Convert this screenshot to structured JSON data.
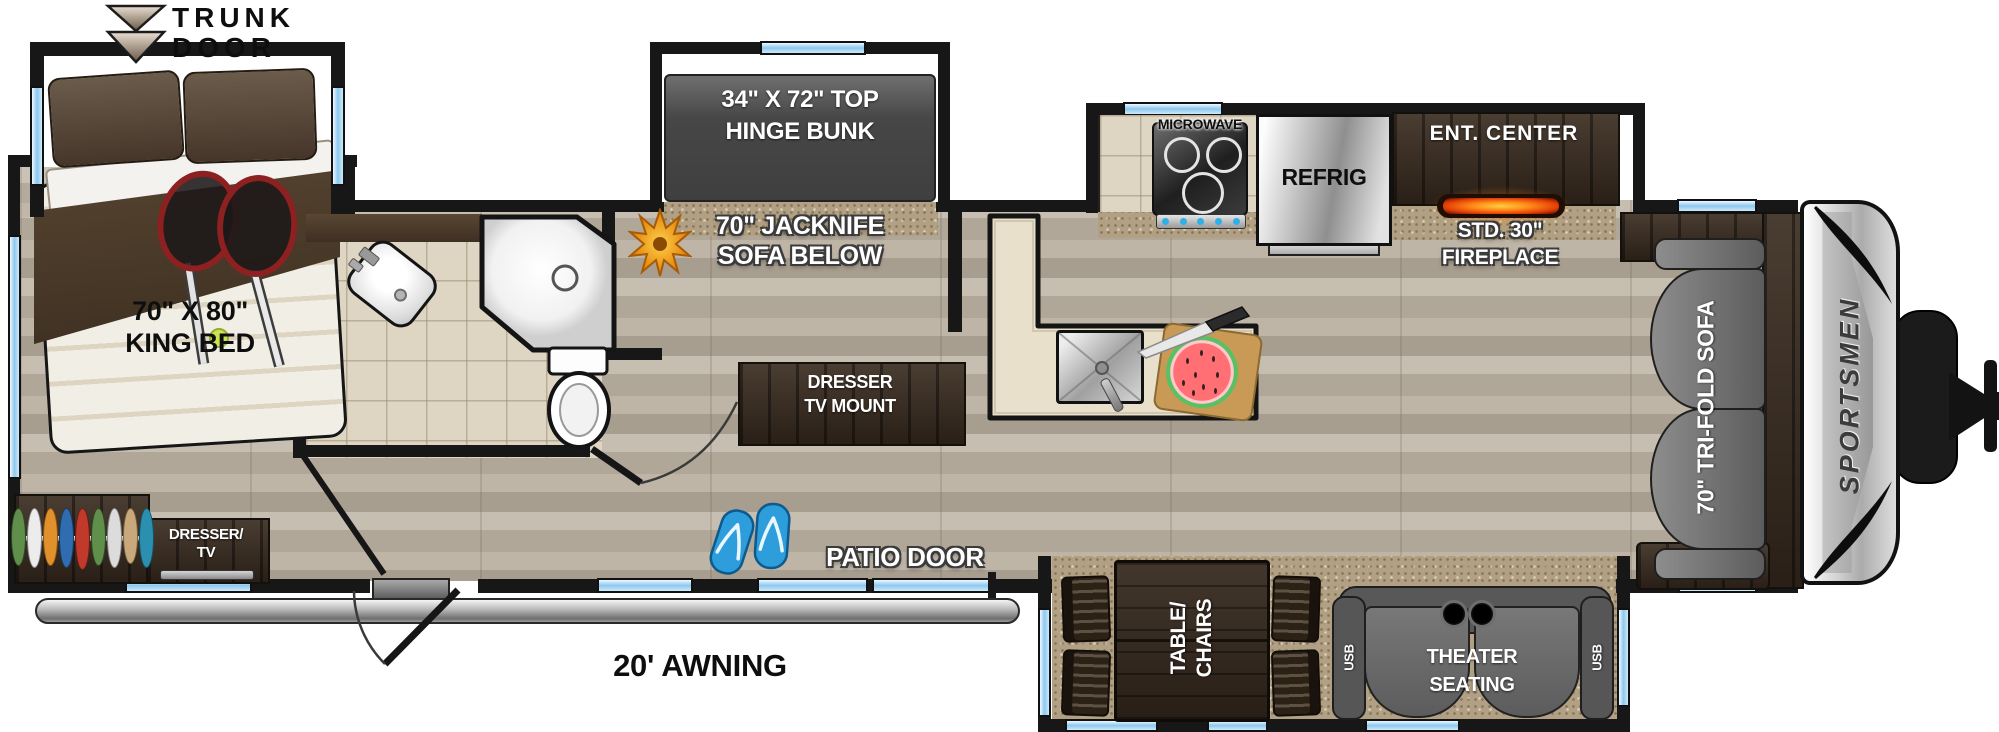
{
  "floorplan": {
    "title": "Sportsmen travel trailer floor plan",
    "brand": "SPORTSMEN",
    "palette": {
      "window_blue": "#8cc8ef",
      "wall_black": "#171717",
      "wood_floor": "#b7aea1",
      "carpet_tan": "#b1a083",
      "dark_wood": "#382a1e",
      "fireplace_glow": "#ff8c1a",
      "flip_flop_blue": "#2798d8",
      "awning_silver": "#c9c9c9"
    },
    "icons": {
      "trunk_door_arrow": "double-chevron-down",
      "flower": "orange-flower",
      "flip_flops": "blue-flip-flops",
      "tennis_rackets": "two-rackets-and-ball",
      "watermelon": "watermelon-on-cutting-board"
    },
    "labels": {
      "trunk_door": {
        "line1": "TRUNK",
        "line2": "DOOR"
      },
      "king_bed": {
        "line1": "70\" X 80\"",
        "line2": "KING BED"
      },
      "bunk": {
        "line1": "34\" X 72\" TOP",
        "line2": "HINGE BUNK"
      },
      "jackknife": {
        "line1": "70\" JACKNIFE",
        "line2": "SOFA BELOW"
      },
      "dresser_tv": {
        "line1": "DRESSER/",
        "line2": "TV"
      },
      "dresser_tv_mount": {
        "line1": "DRESSER",
        "line2": "TV MOUNT"
      },
      "microwave": "MICROWAVE",
      "refrigerator": "REFRIG",
      "ent_center": "ENT. CENTER",
      "fireplace": {
        "line1": "STD. 30\"",
        "line2": "FIREPLACE"
      },
      "patio_door": "PATIO DOOR",
      "awning": "20' AWNING",
      "table_chairs": {
        "line1": "TABLE/",
        "line2": "CHAIRS"
      },
      "theater_seating": {
        "line1": "THEATER",
        "line2": "SEATING"
      },
      "usb_left": "USB",
      "usb_right": "USB",
      "tri_fold_sofa": "70\" TRI-FOLD SOFA"
    }
  }
}
